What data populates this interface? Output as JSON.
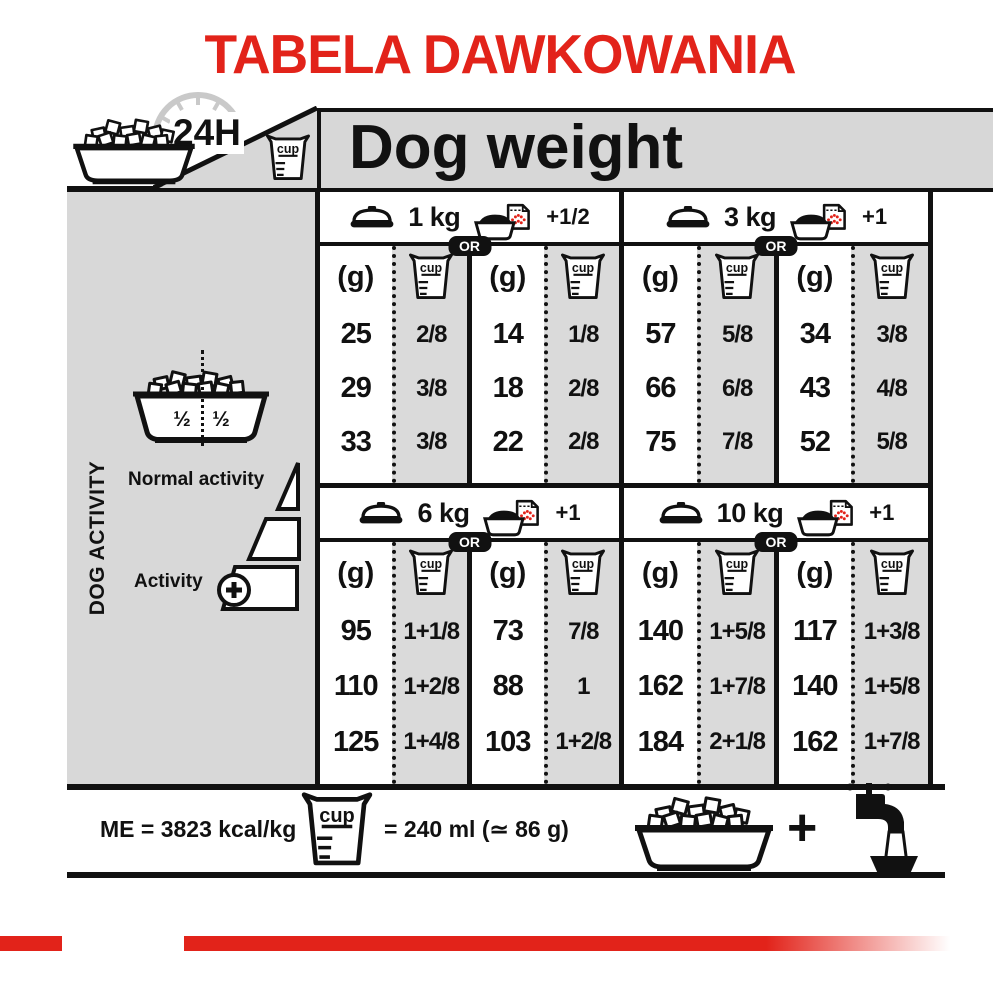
{
  "title": "TABELA DAWKOWANIA",
  "colors": {
    "red": "#e2231a",
    "gray_panel": "#d8d8d8",
    "gray_column": "#dadada",
    "black": "#111111"
  },
  "header": {
    "hours": "24H",
    "dog_weight": "Dog weight"
  },
  "labels": {
    "unit_g": "(g)",
    "cup": "cup",
    "or": "OR",
    "half": "½"
  },
  "sidebar": {
    "vertical": "DOG ACTIVITY",
    "normal": "Normal activity",
    "active": "Activity",
    "bowl_split_left": "½",
    "bowl_split_right": "½"
  },
  "sections": [
    {
      "weight": "1 kg",
      "extra": "+1/2",
      "rows": [
        [
          "25",
          "2/8",
          "14",
          "1/8"
        ],
        [
          "29",
          "3/8",
          "18",
          "2/8"
        ],
        [
          "33",
          "3/8",
          "22",
          "2/8"
        ]
      ]
    },
    {
      "weight": "3 kg",
      "extra": "+1",
      "rows": [
        [
          "57",
          "5/8",
          "34",
          "3/8"
        ],
        [
          "66",
          "6/8",
          "43",
          "4/8"
        ],
        [
          "75",
          "7/8",
          "52",
          "5/8"
        ]
      ]
    },
    {
      "weight": "6 kg",
      "extra": "+1",
      "rows": [
        [
          "95",
          "1+1/8",
          "73",
          "7/8"
        ],
        [
          "110",
          "1+2/8",
          "88",
          "1"
        ],
        [
          "125",
          "1+4/8",
          "103",
          "1+2/8"
        ]
      ]
    },
    {
      "weight": "10 kg",
      "extra": "+1",
      "rows": [
        [
          "140",
          "1+5/8",
          "117",
          "1+3/8"
        ],
        [
          "162",
          "1+7/8",
          "140",
          "1+5/8"
        ],
        [
          "184",
          "2+1/8",
          "162",
          "1+7/8"
        ]
      ]
    }
  ],
  "footer": {
    "me": "ME = 3823 kcal/kg",
    "cup_equiv": "= 240 ml (≃ 86 g)",
    "plus": "+"
  }
}
